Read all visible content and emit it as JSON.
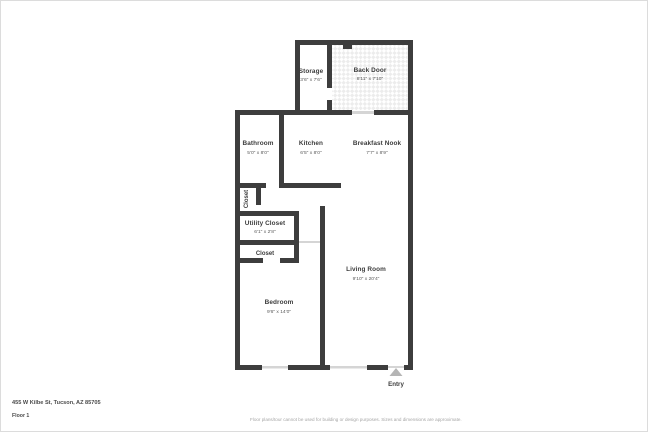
{
  "page": {
    "background": "#ffffff",
    "frame_border_color": "#dcdcdc"
  },
  "floorplan": {
    "wall_color": "#3d3d3d",
    "opening_color": "#d5d5d5",
    "tile_pattern_color": "#ececec",
    "entry_arrow_color": "#b5b5b5",
    "rooms": [
      {
        "id": "storage",
        "name": "Storage",
        "dims": "3'6\" x 7'6\""
      },
      {
        "id": "back-door",
        "name": "Back Door",
        "dims": "8'11\" x 7'10\""
      },
      {
        "id": "bathroom",
        "name": "Bathroom",
        "dims": "5'0\" x 8'0\""
      },
      {
        "id": "kitchen",
        "name": "Kitchen",
        "dims": "6'5\" x 8'0\""
      },
      {
        "id": "breakfast-nook",
        "name": "Breakfast Nook",
        "dims": "7'7\" x 8'9\""
      },
      {
        "id": "closet-upper",
        "name": "Closet",
        "dims": ""
      },
      {
        "id": "utility-closet",
        "name": "Utility Closet",
        "dims": "6'1\" x 2'8\""
      },
      {
        "id": "closet-lower",
        "name": "Closet",
        "dims": ""
      },
      {
        "id": "bedroom",
        "name": "Bedroom",
        "dims": "9'6\" x 14'0\""
      },
      {
        "id": "living-room",
        "name": "Living Room",
        "dims": "9'10\" x 20'4\""
      }
    ],
    "entry_label": "Entry"
  },
  "footer": {
    "address": "455 W Kilbe St, Tucson, AZ 85705",
    "floor_label": "Floor 1",
    "disclaimer": "Floor plans/tour cannot be used for building or design purposes. Sizes and dimensions are approximate."
  }
}
